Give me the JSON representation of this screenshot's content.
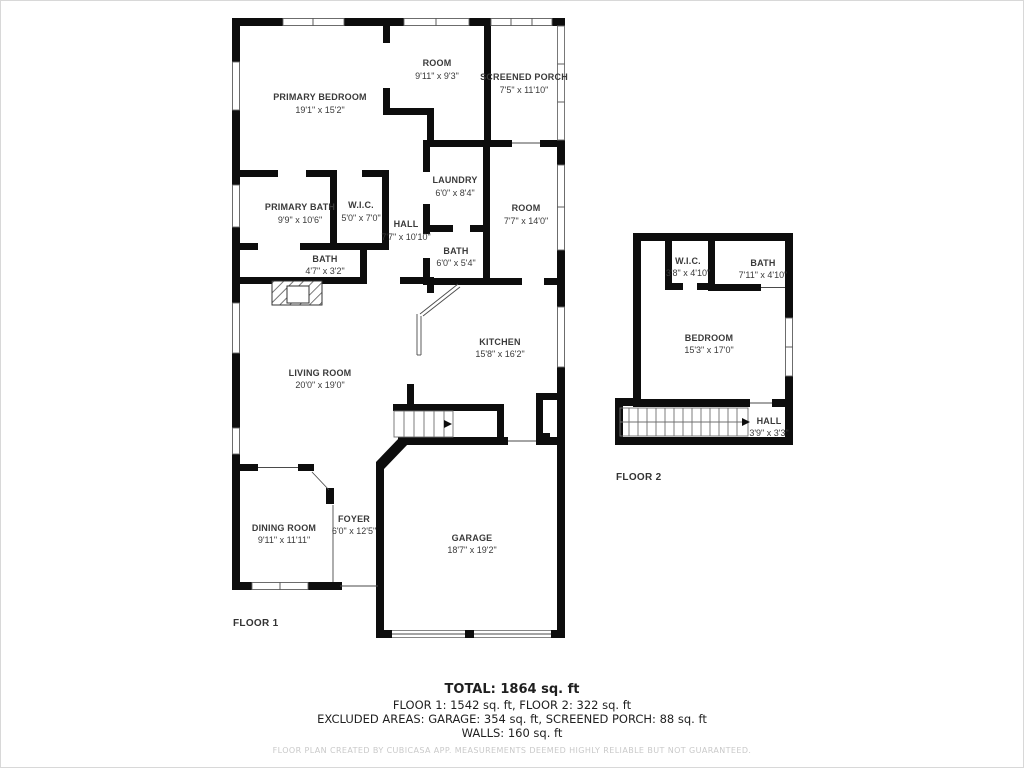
{
  "floor1": {
    "label": "FLOOR 1",
    "rooms": [
      {
        "name": "PRIMARY BEDROOM",
        "dims": "19'1\" x 15'2\""
      },
      {
        "name": "ROOM",
        "dims": "9'11\" x 9'3\""
      },
      {
        "name": "SCREENED PORCH",
        "dims": "7'5\" x 11'10\""
      },
      {
        "name": "PRIMARY BATH",
        "dims": "9'9\" x 10'6\""
      },
      {
        "name": "W.I.C.",
        "dims": "5'0\" x 7'0\""
      },
      {
        "name": "HALL",
        "dims": "7'7\" x 10'10\""
      },
      {
        "name": "LAUNDRY",
        "dims": "6'0\" x 8'4\""
      },
      {
        "name": "ROOM",
        "dims": "7'7\" x 14'0\""
      },
      {
        "name": "BATH",
        "dims": "6'0\" x 5'4\""
      },
      {
        "name": "BATH",
        "dims": "4'7\" x 3'2\""
      },
      {
        "name": "KITCHEN",
        "dims": "15'8\" x 16'2\""
      },
      {
        "name": "LIVING ROOM",
        "dims": "20'0\" x 19'0\""
      },
      {
        "name": "DINING ROOM",
        "dims": "9'11\" x 11'11\""
      },
      {
        "name": "FOYER",
        "dims": "6'0\" x 12'5\""
      },
      {
        "name": "GARAGE",
        "dims": "18'7\" x 19'2\""
      }
    ]
  },
  "floor2": {
    "label": "FLOOR 2",
    "rooms": [
      {
        "name": "W.I.C.",
        "dims": "3'8\" x 4'10\""
      },
      {
        "name": "BATH",
        "dims": "7'11\" x 4'10\""
      },
      {
        "name": "BEDROOM",
        "dims": "15'3\" x 17'0\""
      },
      {
        "name": "HALL",
        "dims": "3'9\" x 3'3\""
      }
    ]
  },
  "summary": {
    "total": "TOTAL: 1864 sq. ft",
    "floors": "FLOOR 1: 1542 sq. ft, FLOOR 2: 322 sq. ft",
    "excluded": "EXCLUDED AREAS: GARAGE: 354 sq. ft, SCREENED PORCH: 88 sq. ft",
    "walls": "WALLS: 160 sq. ft",
    "disclaimer": "FLOOR PLAN CREATED BY CUBICASA APP. MEASUREMENTS DEEMED HIGHLY RELIABLE BUT NOT GUARANTEED."
  },
  "colors": {
    "wall": "#0d0d0d",
    "room_label": "#3a3a3a",
    "disclaimer_gray": "#c9c9c9"
  }
}
